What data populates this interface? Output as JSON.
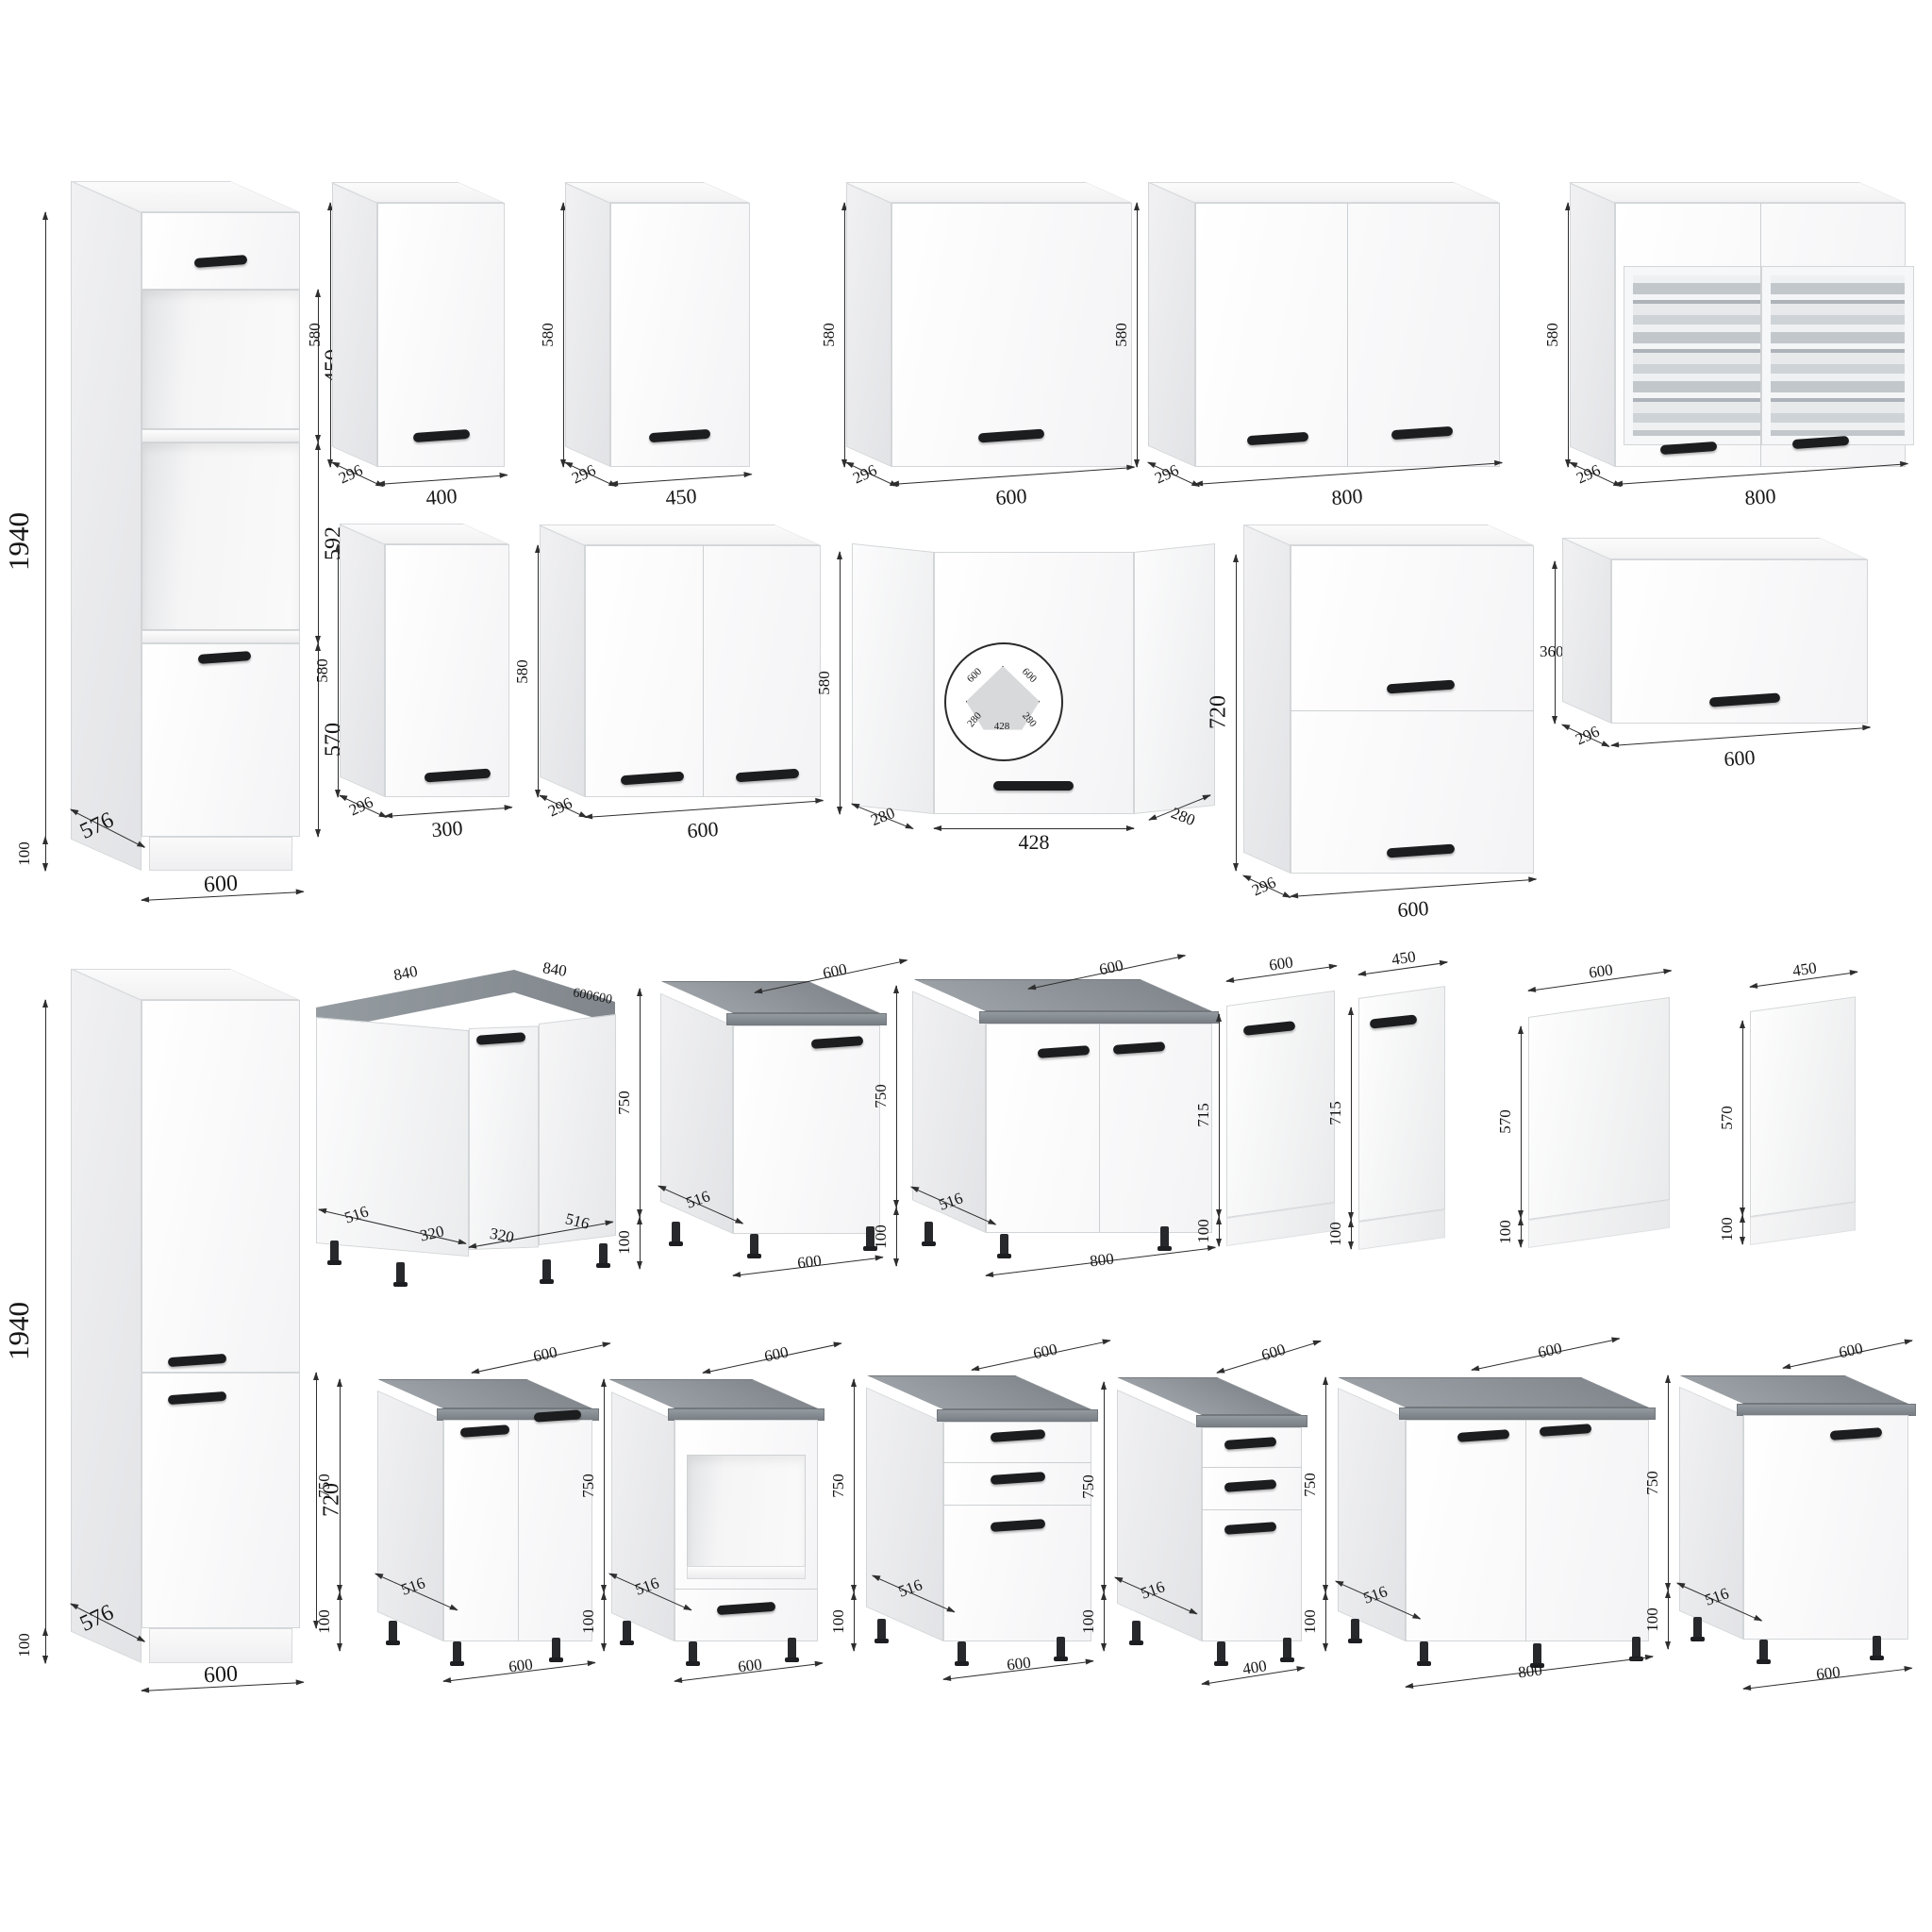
{
  "colors": {
    "countertop": "#8a9095",
    "handle": "#1c1d1f",
    "dimension_line": "#2e2e2e",
    "cabinet": "#ffffff"
  },
  "cabinets": {
    "tall_oven": {
      "height": "1940",
      "section_top": "450",
      "section_middle": "592",
      "section_door": "570",
      "plinth": "100",
      "depth": "576",
      "width": "600"
    },
    "tall_fridge": {
      "height": "1940",
      "lower_door": "720",
      "plinth": "100",
      "depth": "576",
      "width": "600"
    },
    "wall_400": {
      "height": "580",
      "depth": "296",
      "width": "400"
    },
    "wall_450": {
      "height": "580",
      "depth": "296",
      "width": "450"
    },
    "wall_600": {
      "height": "580",
      "depth": "296",
      "width": "600"
    },
    "wall_800": {
      "height": "580",
      "depth": "296",
      "width": "800"
    },
    "wall_800_glass": {
      "height": "580",
      "depth": "296",
      "width": "800"
    },
    "wall_300": {
      "height": "580",
      "depth": "296",
      "width": "300"
    },
    "wall_600_2door": {
      "height": "580",
      "depth": "296",
      "width": "600"
    },
    "wall_corner": {
      "height": "580",
      "side_left": "280",
      "front": "428",
      "side_right": "280",
      "plan_left": "600",
      "plan_right": "600",
      "plan_depth_left": "280",
      "plan_depth_right": "280",
      "plan_front": "428"
    },
    "wall_600_2flap": {
      "height": "720",
      "depth": "296",
      "width": "600"
    },
    "wall_600_flap": {
      "height": "360",
      "depth": "296",
      "width": "600"
    },
    "base_corner": {
      "top_left": "840",
      "top_right": "840",
      "top_edge": "600600",
      "bottom_1": "516",
      "bottom_2": "320",
      "bottom_3": "320",
      "bottom_4": "516",
      "height": "750",
      "plinth": "100"
    },
    "base_600": {
      "top_depth": "600",
      "depth": "516",
      "width": "600"
    },
    "base_800": {
      "height": "750",
      "plinth": "100",
      "top_depth": "600",
      "depth": "516",
      "width": "800"
    },
    "panel_600_dw": {
      "width": "600",
      "height": "715",
      "plinth": "100"
    },
    "panel_450_dw": {
      "width": "450",
      "height": "715",
      "plinth": "100"
    },
    "panel_600_side": {
      "width": "600",
      "height": "570",
      "plinth": "100"
    },
    "panel_450_side": {
      "width": "450",
      "height": "570",
      "plinth": "100"
    },
    "base_600_2door": {
      "top_depth": "600",
      "height": "750",
      "plinth": "100",
      "depth": "516",
      "width": "600"
    },
    "base_oven": {
      "top_depth": "600",
      "height": "750",
      "plinth": "100",
      "depth": "516",
      "width": "600"
    },
    "base_600_drawers": {
      "top_depth": "600",
      "height": "750",
      "plinth": "100",
      "depth": "516",
      "width": "600"
    },
    "base_400_drawers": {
      "top_depth": "600",
      "height": "750",
      "plinth": "100",
      "depth": "516",
      "width": "400"
    },
    "base_800_2door": {
      "top_depth": "600",
      "height": "750",
      "plinth": "100",
      "depth": "516",
      "width": "800"
    },
    "base_600_door": {
      "top_depth": "600",
      "height": "750",
      "plinth": "100",
      "depth": "516",
      "width": "600"
    }
  }
}
